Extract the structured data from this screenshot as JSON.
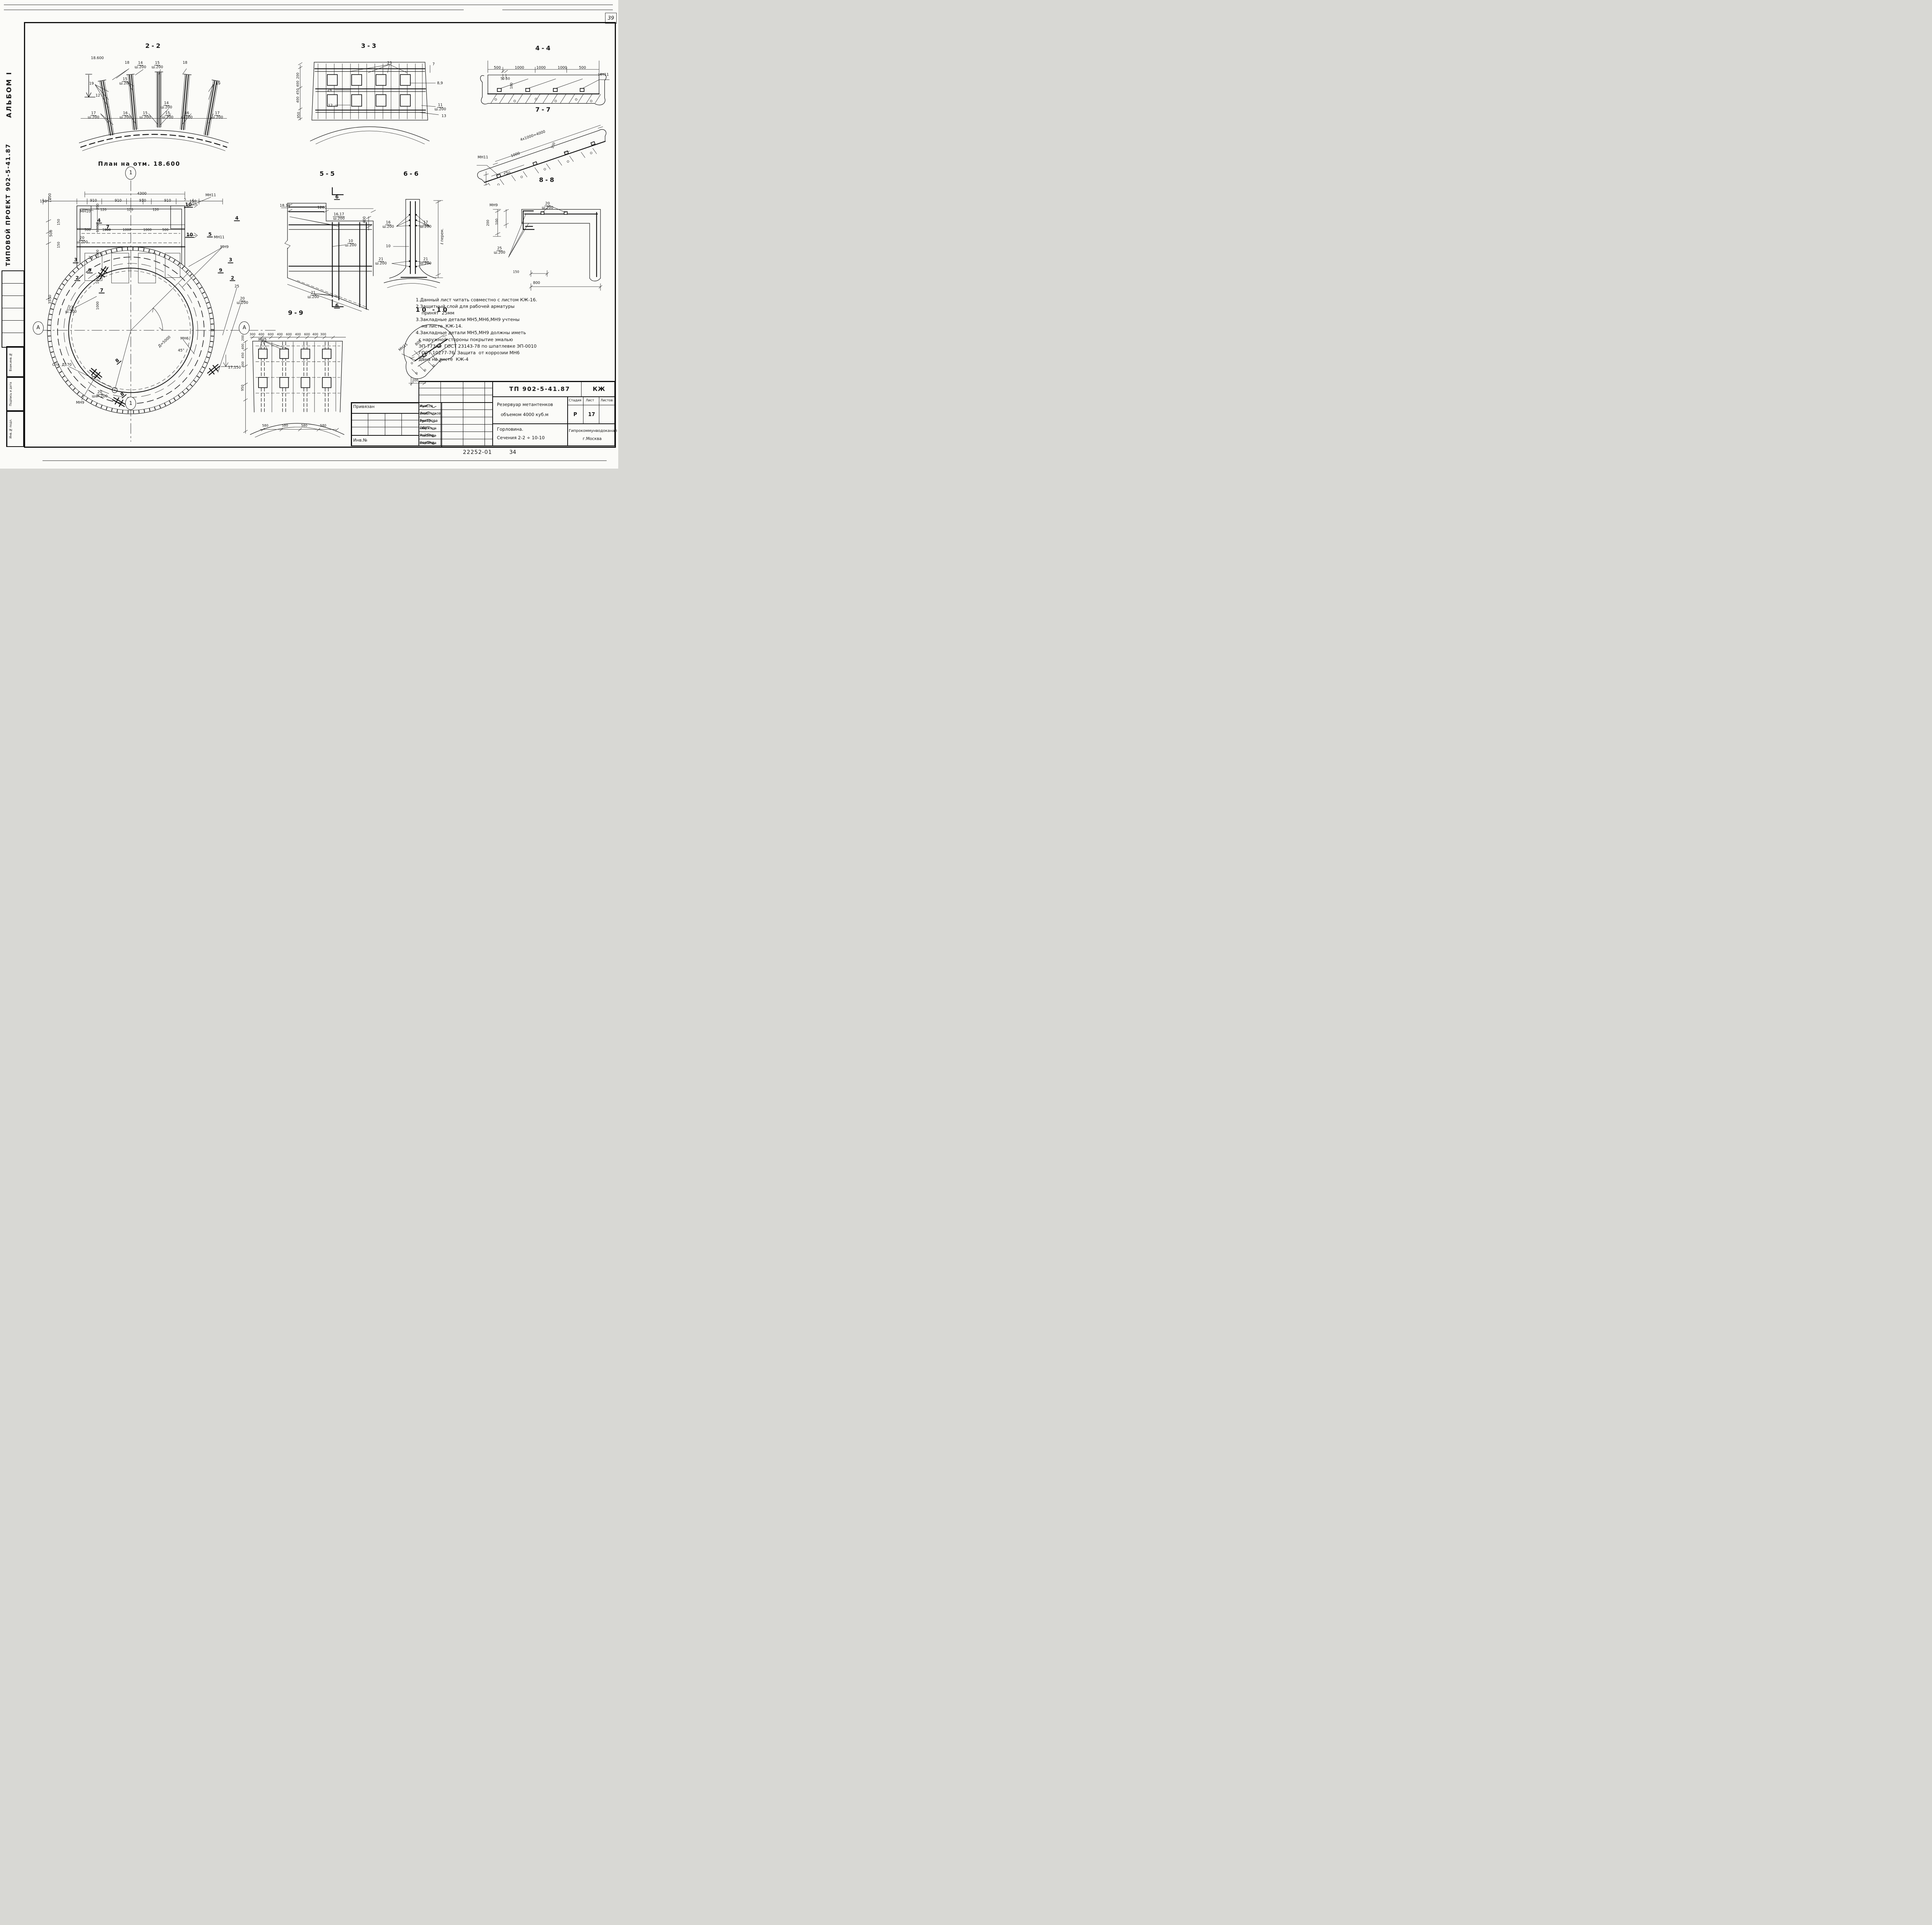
{
  "page": {
    "corner": "39",
    "doc_no": "22252-01",
    "page_no": "34"
  },
  "side_margin": {
    "album": "АЛЬБОМ I",
    "project": "ТИПОВОЙ ПРОЕКТ 902-5-41.87",
    "cells": [
      "Взам.инв.№",
      "Подпись и дата",
      "Инв.№ подл."
    ]
  },
  "plan": {
    "title": "План на отм. 18.600",
    "axis_top": "1",
    "axis_bottom": "1",
    "axis_left": "А",
    "axis_right": "А",
    "labels": [
      {
        "t": "4300",
        "x": 43.1,
        "y": 8.8
      },
      {
        "t": "150",
        "x": 2.4,
        "y": 11.6
      },
      {
        "t": "910",
        "x": 23.1,
        "y": 11.3
      },
      {
        "t": "910",
        "x": 33.3,
        "y": 11.3
      },
      {
        "t": "910",
        "x": 43.4,
        "y": 11.3
      },
      {
        "t": "910",
        "x": 53.7,
        "y": 11.3
      },
      {
        "t": "5",
        "x": 60.9,
        "y": 10.8,
        "fs": 8.5
      },
      {
        "t": "150",
        "x": 64.2,
        "y": 11.6
      },
      {
        "t": "120",
        "x": 27.2,
        "y": 14.6,
        "fs": 8.5
      },
      {
        "t": "120",
        "x": 38.2,
        "y": 14.6,
        "fs": 8.5
      },
      {
        "t": "120",
        "x": 48.8,
        "y": 14.6,
        "fs": 8.5
      },
      {
        "t": "МН11",
        "x": 71.5,
        "y": 9.3
      },
      {
        "t": "МН10",
        "x": 19.8,
        "y": 15.2
      },
      {
        "t": "250",
        "x": 25.0,
        "y": 13.4,
        "r": -90,
        "fs": 8.5
      },
      {
        "t": "1000",
        "x": 25.0,
        "y": 21.0,
        "r": -90,
        "fs": 8.5
      },
      {
        "t": "1000",
        "x": 25.0,
        "y": 30.3,
        "r": -90,
        "fs": 8.5
      },
      {
        "t": "1000",
        "x": 25.0,
        "y": 39.6,
        "r": -90,
        "fs": 8.5
      },
      {
        "t": "1000",
        "x": 25.0,
        "y": 48.9,
        "r": -90,
        "fs": 8.5
      },
      {
        "t": "1200",
        "x": 5.2,
        "y": 10.2,
        "r": -90
      },
      {
        "t": "150",
        "x": 8.9,
        "y": 18.9,
        "r": -90,
        "fs": 8.5
      },
      {
        "t": "500",
        "x": 5.8,
        "y": 22.9,
        "r": -90
      },
      {
        "t": "150",
        "x": 8.9,
        "y": 27.1,
        "r": -90,
        "fs": 8.5
      },
      {
        "t": "3550",
        "x": 5.2,
        "y": 46.8,
        "r": -90
      },
      {
        "t": "500",
        "x": 20.7,
        "y": 21.8,
        "fs": 8.5
      },
      {
        "t": "1000",
        "x": 28.5,
        "y": 21.8,
        "fs": 8.5
      },
      {
        "t": "1000",
        "x": 36.9,
        "y": 21.8,
        "fs": 8.5
      },
      {
        "t": "1000",
        "x": 45.4,
        "y": 21.8,
        "fs": 8.5
      },
      {
        "t": "500",
        "x": 52.8,
        "y": 21.8,
        "fs": 8.5
      },
      {
        "t": "4",
        "x": 25.4,
        "y": 18.3,
        "c": "mk"
      },
      {
        "t": "7",
        "x": 29.0,
        "y": 20.7,
        "c": "mk"
      },
      {
        "t": "10",
        "x": 62.3,
        "y": 12.6,
        "c": "mk"
      },
      {
        "t": "10",
        "x": 62.8,
        "y": 23.5,
        "c": "mk"
      },
      {
        "t": "4",
        "x": 82.3,
        "y": 17.5,
        "c": "mk"
      },
      {
        "t": "5",
        "x": 71.2,
        "y": 23.3,
        "c": "mk"
      },
      {
        "t": "МН11",
        "x": 75.0,
        "y": 24.5
      },
      {
        "t": "МН9",
        "x": 77.2,
        "y": 28.0
      },
      {
        "t": "20|ш.200",
        "x": 18.4,
        "y": 25.5
      },
      {
        "t": "25",
        "x": 22.0,
        "y": 31.9
      },
      {
        "t": "3",
        "x": 15.8,
        "y": 32.6,
        "c": "mk"
      },
      {
        "t": "9",
        "x": 21.6,
        "y": 36.3,
        "c": "mk"
      },
      {
        "t": "2",
        "x": 16.4,
        "y": 39.1,
        "c": "mk"
      },
      {
        "t": "7",
        "x": 26.5,
        "y": 43.5,
        "c": "mk"
      },
      {
        "t": "3",
        "x": 79.7,
        "y": 32.6,
        "c": "mk"
      },
      {
        "t": "9",
        "x": 75.6,
        "y": 36.3,
        "c": "mk"
      },
      {
        "t": "2",
        "x": 80.5,
        "y": 39.1,
        "c": "mk"
      },
      {
        "t": "25",
        "x": 82.3,
        "y": 42.1
      },
      {
        "t": "20|ш.200",
        "x": 84.6,
        "y": 47.3
      },
      {
        "t": "22|ш.200",
        "x": 13.8,
        "y": 50.5
      },
      {
        "t": "8",
        "x": 33.0,
        "y": 68.8,
        "r": -40,
        "c": "mk"
      },
      {
        "t": "8",
        "x": 35.1,
        "y": 80.9,
        "r": -40,
        "c": "mk"
      },
      {
        "t": "Д=5000",
        "x": 52.5,
        "y": 62.0,
        "r": -42
      },
      {
        "t": "45°",
        "x": 59.3,
        "y": 65.2
      },
      {
        "t": "МН6",
        "x": 60.7,
        "y": 60.9
      },
      {
        "t": "Отв. Д170",
        "x": 10.1,
        "y": 70.4
      },
      {
        "t": "25",
        "x": 23.1,
        "y": 75.0
      },
      {
        "t": "20|шаг 200",
        "x": 25.7,
        "y": 81.0
      },
      {
        "t": "МН9",
        "x": 17.6,
        "y": 84.0
      },
      {
        "t": "17,150",
        "x": 81.3,
        "y": 71.3
      }
    ]
  },
  "sections": {
    "s22": {
      "title": "2-2",
      "labels": [
        {
          "t": "18.600",
          "x": 13.3,
          "y": 6.2
        },
        {
          "t": "18",
          "x": 32.6,
          "y": 10.3
        },
        {
          "t": "14|ш.200",
          "x": 41.3,
          "y": 12.2
        },
        {
          "t": "15|ш.200",
          "x": 52.3,
          "y": 12.2
        },
        {
          "t": "18",
          "x": 70.3,
          "y": 10.3
        },
        {
          "t": "19",
          "x": 9.5,
          "y": 28.3
        },
        {
          "t": "15|ш.200",
          "x": 31.3,
          "y": 26.4
        },
        {
          "t": "12",
          "x": 13.6,
          "y": 39.0
        },
        {
          "t": "14|ш.200",
          "x": 58.2,
          "y": 47.4
        },
        {
          "t": "17|ш.200",
          "x": 10.8,
          "y": 56.0
        },
        {
          "t": "16|ш.200",
          "x": 31.5,
          "y": 56.0
        },
        {
          "t": "15|ш.200",
          "x": 44.4,
          "y": 56.0
        },
        {
          "t": "15|ш.200",
          "x": 59.0,
          "y": 56.0
        },
        {
          "t": "16|ш.200",
          "x": 71.5,
          "y": 56.0
        },
        {
          "t": "17|ш.200",
          "x": 91.3,
          "y": 56.0
        },
        {
          "t": "19",
          "x": 91.8,
          "y": 28.3
        }
      ]
    },
    "s33": {
      "title": "3-3",
      "labels": [
        {
          "t": "23",
          "x": 62.8,
          "y": 12.8
        },
        {
          "t": "7",
          "x": 91.1,
          "y": 14.0
        },
        {
          "t": "8,9",
          "x": 95.2,
          "y": 34.5
        },
        {
          "t": "24",
          "x": 24.3,
          "y": 42.1
        },
        {
          "t": "12",
          "x": 24.8,
          "y": 58.7
        },
        {
          "t": "11|ш.200",
          "x": 95.4,
          "y": 60.6
        },
        {
          "t": "13",
          "x": 97.7,
          "y": 69.8
        },
        {
          "t": "200",
          "x": 4.1,
          "y": 26.4,
          "r": -90,
          "fs": 8.5
        },
        {
          "t": "400",
          "x": 4.1,
          "y": 34.9,
          "r": -90,
          "fs": 8.5
        },
        {
          "t": "450",
          "x": 4.1,
          "y": 43.4,
          "r": -90,
          "fs": 8.5
        },
        {
          "t": "400",
          "x": 4.1,
          "y": 51.9,
          "r": -90,
          "fs": 8.5
        },
        {
          "t": "950",
          "x": 4.6,
          "y": 68.9,
          "r": -90,
          "fs": 8.5
        }
      ]
    },
    "s44": {
      "title": "4-4",
      "labels": [
        {
          "t": "500",
          "x": 15.3,
          "y": 22.9
        },
        {
          "t": "1000",
          "x": 31.8,
          "y": 22.9
        },
        {
          "t": "1000",
          "x": 47.9,
          "y": 22.9
        },
        {
          "t": "1000",
          "x": 63.8,
          "y": 22.9
        },
        {
          "t": "500",
          "x": 78.8,
          "y": 22.9
        },
        {
          "t": "50 50",
          "x": 21.2,
          "y": 43.6,
          "fs": 8.5
        },
        {
          "t": "180",
          "x": 26.2,
          "y": 55.0,
          "r": -90,
          "fs": 8.5
        },
        {
          "t": "МН11",
          "x": 94.5,
          "y": 36.0
        }
      ]
    },
    "s77": {
      "title": "7-7",
      "labels": [
        {
          "t": "4x1000=4000",
          "x": 42.2,
          "y": 30.6,
          "r": -19
        },
        {
          "t": "1000",
          "x": 30.0,
          "y": 57.0,
          "r": -19
        },
        {
          "t": "100",
          "x": 57.0,
          "y": 44.0,
          "r": -70,
          "fs": 8.5
        },
        {
          "t": "МН11",
          "x": 7.0,
          "y": 61.0
        },
        {
          "t": "250",
          "x": 24.0,
          "y": 83.0
        }
      ]
    },
    "s55": {
      "title": "5-5",
      "labels": [
        {
          "t": "6",
          "x": 58.5,
          "y": 13.4,
          "c": "mk"
        },
        {
          "t": "18,19",
          "x": 8.7,
          "y": 20.3
        },
        {
          "t": "1200",
          "x": 44.2,
          "y": 21.5
        },
        {
          "t": "16,17|ш.200",
          "x": 60.4,
          "y": 28.4
        },
        {
          "t": "400",
          "x": 85.0,
          "y": 30.7,
          "r": -90
        },
        {
          "t": "10|ш.200",
          "x": 71.7,
          "y": 48.6
        },
        {
          "t": "21|ш.200",
          "x": 35.8,
          "y": 87.6
        },
        {
          "t": "6",
          "x": 58.5,
          "y": 95.5,
          "c": "mk"
        }
      ]
    },
    "s66": {
      "title": "6-6",
      "labels": [
        {
          "t": "16|ш.200",
          "x": 16.7,
          "y": 42.0
        },
        {
          "t": "17|ш.200",
          "x": 69.4,
          "y": 42.0
        },
        {
          "t": "10",
          "x": 16.7,
          "y": 61.8
        },
        {
          "t": "21|ш.200",
          "x": 6.5,
          "y": 75.8
        },
        {
          "t": "21|ш.200",
          "x": 69.4,
          "y": 75.8
        },
        {
          "t": "ℓ перем.",
          "x": 92.8,
          "y": 52.7,
          "r": -90
        }
      ]
    },
    "s88": {
      "title": "8-8",
      "labels": [
        {
          "t": "МН9",
          "x": 7.2,
          "y": 17.6
        },
        {
          "t": "20|ш.200",
          "x": 50.0,
          "y": 18.0
        },
        {
          "t": "200",
          "x": 3.1,
          "y": 32.8,
          "r": -90,
          "fs": 8.5
        },
        {
          "t": "100",
          "x": 10.0,
          "y": 31.7,
          "r": -90,
          "fs": 8.5
        },
        {
          "t": "25|ш.200",
          "x": 11.9,
          "y": 57.0
        },
        {
          "t": "150",
          "x": 25.0,
          "y": 75.9,
          "fs": 8.5
        },
        {
          "t": "800",
          "x": 41.3,
          "y": 85.5
        }
      ]
    },
    "s99": {
      "title": "9-9",
      "labels": [
        {
          "t": "300",
          "x": 12.1,
          "y": 13.6,
          "fs": 8
        },
        {
          "t": "400",
          "x": 19.7,
          "y": 13.6,
          "fs": 8
        },
        {
          "t": "600",
          "x": 27.8,
          "y": 13.6,
          "fs": 8
        },
        {
          "t": "400",
          "x": 35.6,
          "y": 13.6,
          "fs": 8
        },
        {
          "t": "600",
          "x": 43.4,
          "y": 13.6,
          "fs": 8
        },
        {
          "t": "400",
          "x": 51.2,
          "y": 13.6,
          "fs": 8
        },
        {
          "t": "600",
          "x": 59.0,
          "y": 13.6,
          "fs": 8
        },
        {
          "t": "400",
          "x": 66.1,
          "y": 13.6,
          "fs": 8
        },
        {
          "t": "300",
          "x": 72.9,
          "y": 13.6,
          "fs": 8
        },
        {
          "t": "МН5",
          "x": 20.7,
          "y": 18.2
        },
        {
          "t": "200",
          "x": 4.1,
          "y": 16.6,
          "r": -90,
          "fs": 8
        },
        {
          "t": "400",
          "x": 4.1,
          "y": 23.8,
          "r": -90,
          "fs": 8
        },
        {
          "t": "450",
          "x": 4.1,
          "y": 31.1,
          "r": -90,
          "fs": 8
        },
        {
          "t": "400",
          "x": 4.1,
          "y": 38.7,
          "r": -90,
          "fs": 8
        },
        {
          "t": "950",
          "x": 4.1,
          "y": 58.6,
          "r": -90,
          "fs": 8.5
        },
        {
          "t": "580",
          "x": 23.1,
          "y": 90.7,
          "fs": 8.5
        },
        {
          "t": "580",
          "x": 40.0,
          "y": 90.7,
          "fs": 8.5
        },
        {
          "t": "580",
          "x": 56.6,
          "y": 90.7,
          "fs": 8.5
        },
        {
          "t": "580",
          "x": 72.9,
          "y": 90.7,
          "fs": 8.5
        }
      ]
    },
    "s1010": {
      "title": "10 -10",
      "labels": [
        {
          "t": "МН11",
          "x": 8.0,
          "y": 44.0,
          "r": -40
        },
        {
          "t": "800",
          "x": 30.0,
          "y": 38.0,
          "r": -40
        },
        {
          "t": "100",
          "x": 37.0,
          "y": 57.0,
          "r": -40,
          "fs": 8
        },
        {
          "t": "200",
          "x": 25.0,
          "y": 90.0,
          "fs": 8.5
        }
      ]
    }
  },
  "notes": {
    "lines": [
      "1.Данный лист читать совместно с листом КЖ-16.",
      "2.Защитный слой для рабочей арматуры",
      "    принят  25мм",
      "3.Закладные детали МН5,МН6,МН9 учтены",
      "    на листе  КЖ-14.",
      "4.Закладные детали МН5,МН9 должны иметь",
      "  с наружной стороны покрытие эмалью",
      "  ЭП-773хВ  ГОСТ 23143-78 по шпатлевке ЭП-0010",
      "  ГОСТ 10277-76. Защита  от коррозии МН6",
      "  дана на листе  КЖ-4"
    ]
  },
  "titleblock": {
    "privyazan": "Привязан",
    "inv": "Инв.№",
    "rows": [
      {
        "role": "Инж.",
        "name": "Куксов"
      },
      {
        "role": "Инж.",
        "name": "Олейников"
      },
      {
        "role": "Рук.гр.",
        "name": "Булатова"
      },
      {
        "role": "ГИП конс",
        "name": "Обух"
      },
      {
        "role": "Н.контр",
        "name": "Ройзман"
      },
      {
        "role": "Нач.отд.",
        "name": "Сорокин"
      }
    ],
    "doc_code": "ТП 902-5-41.87",
    "mark": "КЖ",
    "object1": "Резервуар метантенков",
    "object2": "объемом 4000 куб.м",
    "stage_h": "Стадия",
    "sheet_h": "Лист",
    "sheets_h": "Листов",
    "stage": "Р",
    "sheet": "17",
    "sheets": "",
    "subtitle1": "Горловина.",
    "subtitle2": "Сечения 2-2 ÷ 10-10",
    "org1": "Гипрокоммунводоканал",
    "org2": "г.Москва"
  }
}
